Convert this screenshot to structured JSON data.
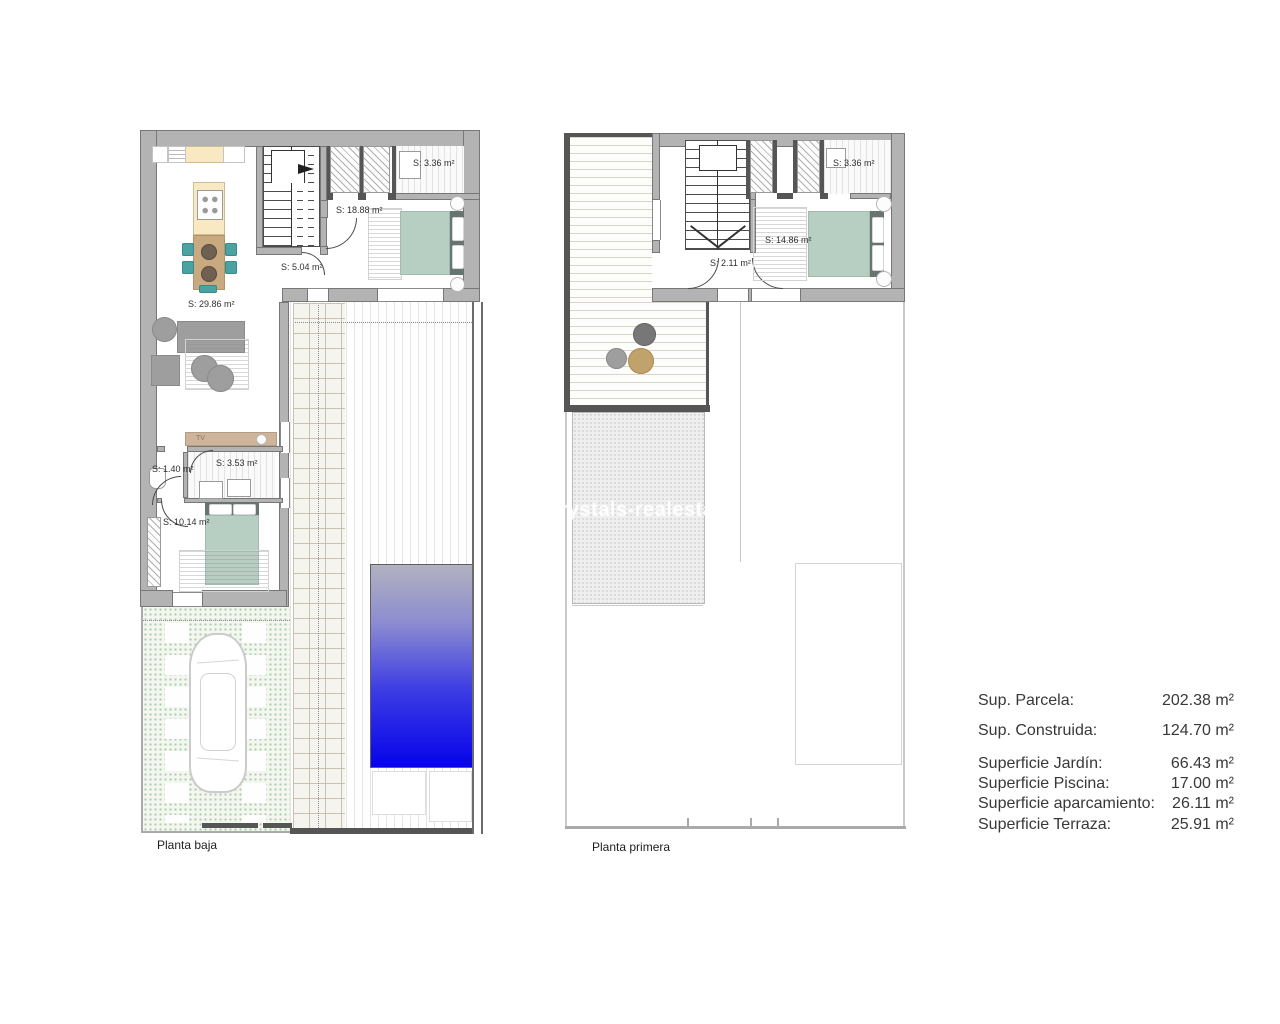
{
  "watermark": "crystals-realestate",
  "plans": {
    "ground": {
      "caption": "Planta baja",
      "rooms": {
        "living": "S: 29.86 m²",
        "hall": "S: 5.04 m²",
        "bedroom_main": "S: 18.88 m²",
        "bath_top": "S: 3.36 m²",
        "wc": "S: 1.40 m²",
        "bath_small": "S: 3.53 m²",
        "bedroom_small": "S: 10.14 m²",
        "tv_label": "TV"
      }
    },
    "first": {
      "caption": "Planta primera",
      "rooms": {
        "hall": "S: 2.11 m²",
        "bedroom": "S: 14.86 m²",
        "bath": "S: 3.36 m²"
      }
    }
  },
  "summary": {
    "rows": [
      {
        "label": "Sup. Parcela:",
        "value": "202.38 m²"
      },
      {
        "label": "Sup. Construida:",
        "value": "124.70 m²"
      },
      {
        "label": "Superficie Jardín:",
        "value": "66.43 m²"
      },
      {
        "label": "Superficie Piscina:",
        "value": "17.00 m²"
      },
      {
        "label": "Superficie aparcamiento:",
        "value": "26.11 m²"
      },
      {
        "label": "Superficie Terraza:",
        "value": "25.91 m²"
      }
    ]
  },
  "colors": {
    "wall": "#b3b3b3",
    "wall-dark": "#555555",
    "pool-top": "#b1b1bf",
    "pool-bottom": "#0603ea",
    "bed": "#b7cfc3",
    "headboard": "#68746f",
    "chair-teal": "#4ba2a2",
    "counter": "#f8e9c2",
    "table-tan": "#c9aa80",
    "tv-tan": "#cdb49b",
    "sofa": "#9e9e9e",
    "garden-bg": "#f3f7f0",
    "garden-dot": "#aecbae",
    "deck-line": "#d9d5c9",
    "text": "#383838"
  }
}
